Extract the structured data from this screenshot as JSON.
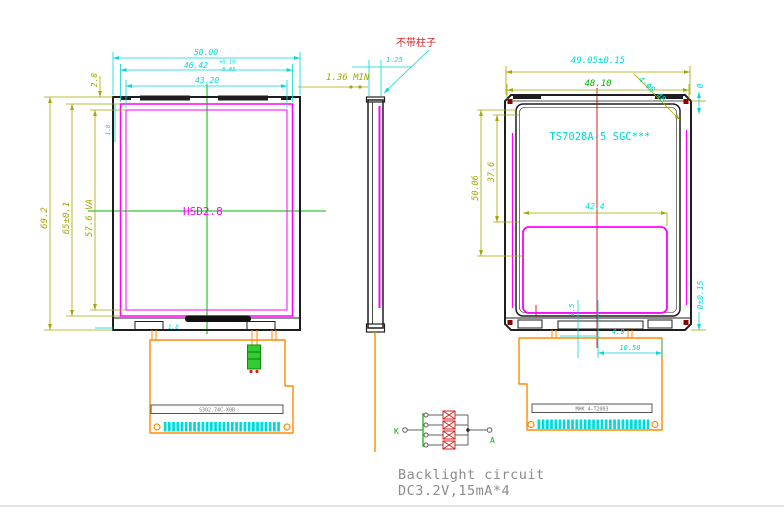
{
  "front_view": {
    "label": "HSD2.8",
    "fpc_label": "S302.74C-X0B",
    "dims": {
      "width_outer": "50.00",
      "width_mid": "46.42",
      "tol_up": "+0.10",
      "tol_dn": "-0.05",
      "width_inner": "43.20",
      "height_outer": "69.2",
      "height_mid": "65±0.1",
      "height_va": "57.6 VA",
      "top_offset": "2.8",
      "small_top": "1.8",
      "small_bottom": "1.8"
    }
  },
  "side_view": {
    "dim_min": "1.36 MIN",
    "dim_top": "1.25",
    "note": "不带柱子"
  },
  "back_view": {
    "label": "TS7028A-5 SGC***",
    "fpc_label": "MHK 4-T2003",
    "dims": {
      "width_outer": "49.05±0.15",
      "width_inner": "48.10",
      "holes": "4-Φ0.48",
      "right_top": "0",
      "right_bottom": "0±0.15",
      "height_1": "50.06",
      "height_2": "37.6",
      "width_mid": "42.4",
      "small_1": "4.0",
      "bottom_width": "10.50",
      "small_2": "1.5"
    }
  },
  "circuit": {
    "terminal_k": "K",
    "terminal_a": "A",
    "title": "Backlight circuit",
    "spec": "DC3.2V,15mA*4"
  },
  "colors": {
    "dim_cyan": "#00d9d9",
    "dim_olive": "#a6a600",
    "centerline_green": "#00b400",
    "outline_black": "#1e1e1e",
    "frame_magenta": "#ff00ff",
    "fpc_orange": "#ff8a00",
    "accent_red": "#d42020",
    "note_gray": "#8c8c8c"
  }
}
